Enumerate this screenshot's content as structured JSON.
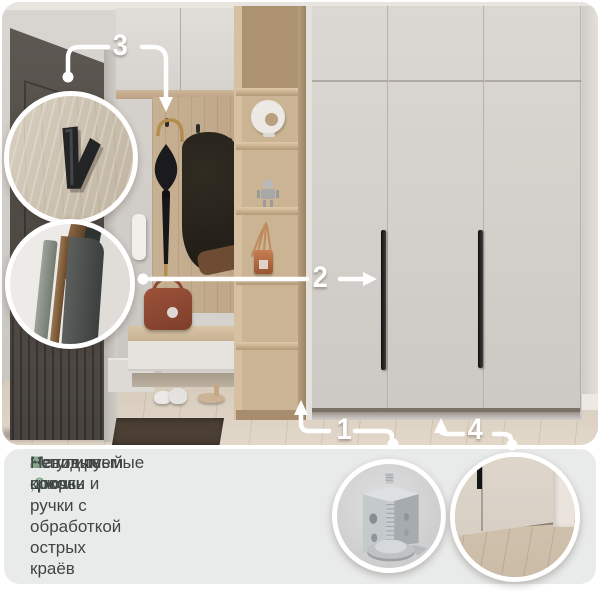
{
  "colors": {
    "accent_green": "#86a98e",
    "body_text": "#3e4543",
    "panel_background": "#e9ebea",
    "annotation_lines": "#ffffff",
    "wardrobe_door": "#d3cfca",
    "wood_shelf": "#c9b394"
  },
  "markers": {
    "m1": "1",
    "m2": "2",
    "m3": "3",
    "m4": "4"
  },
  "features": [
    {
      "num": "1.",
      "text": "Регулируемые опоры"
    },
    {
      "num": "2 ,3.",
      "text": "Матовые крючки и ручки с обработкой острых краёв"
    },
    {
      "num": "4.",
      "text": "Невидимый цоколь"
    }
  ],
  "callouts": {
    "hook": "hook-detail",
    "panel_edge": "panel-edge-detail",
    "foot": "adjustable-foot-detail",
    "plinth": "plinth-detail"
  }
}
